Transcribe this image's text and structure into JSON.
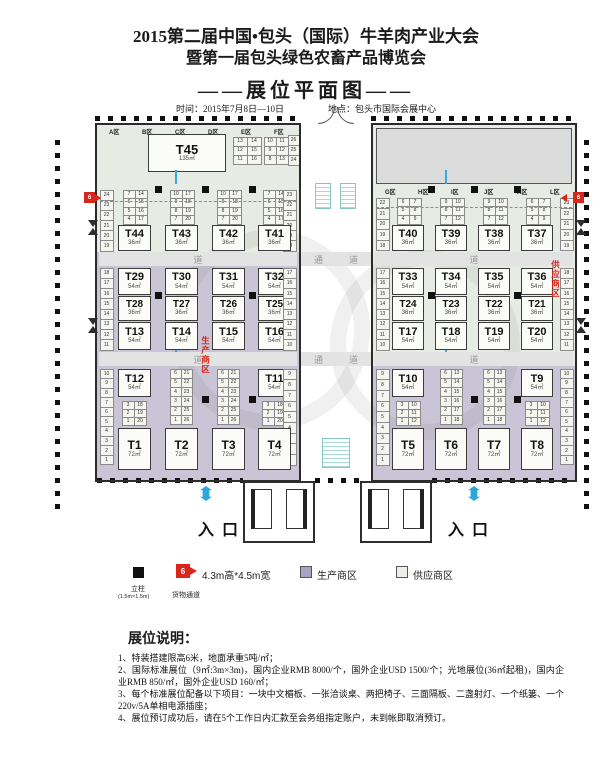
{
  "header": {
    "title_line1": "2015第二届中国•包头（国际）牛羊肉产业大会",
    "title_line2": "暨第一届包头绿色农畜产品博览会",
    "plan_title": "——展位平面图——",
    "time_label": "时间：2015年7月8日—10日",
    "venue_label": "地点：包头市国际会展中心"
  },
  "plan": {
    "entrance_label": "入口",
    "corridor_chars": [
      "通",
      "道"
    ],
    "aisle_char": "道",
    "production_area_label": "生产商区",
    "supply_area_label": "供应商区",
    "goods_channel_num": "6",
    "left_hall": {
      "zones": [
        "A区",
        "B区",
        "C区",
        "D区",
        "E区",
        "F区"
      ],
      "big_booth": {
        "id": "T45",
        "size": "135㎡"
      },
      "t45_grids": [
        [
          [
            "13",
            "14"
          ],
          [
            "12",
            "15"
          ],
          [
            "11",
            "16"
          ]
        ],
        [
          [
            "10",
            "11"
          ],
          [
            "9",
            "12"
          ],
          [
            "8",
            "13"
          ]
        ]
      ],
      "corner_strip": [
        "26",
        "25",
        "24"
      ],
      "row1_grids": [
        [
          [
            "7",
            "14"
          ],
          [
            "6",
            "15"
          ],
          [
            "5",
            "16"
          ],
          [
            "4",
            "17"
          ]
        ],
        [
          [
            "10",
            "17"
          ],
          [
            "9",
            "18"
          ],
          [
            "8",
            "19"
          ],
          [
            "7",
            "20"
          ]
        ],
        [
          [
            "10",
            "17"
          ],
          [
            "9",
            "18"
          ],
          [
            "8",
            "19"
          ],
          [
            "7",
            "20"
          ]
        ],
        [
          [
            "7",
            "14"
          ],
          [
            "6",
            "15"
          ],
          [
            "5",
            "16"
          ],
          [
            "4",
            "17"
          ]
        ]
      ],
      "row1_booths": [
        {
          "id": "T44",
          "size": "36㎡"
        },
        {
          "id": "T43",
          "size": "36㎡"
        },
        {
          "id": "T42",
          "size": "36㎡"
        },
        {
          "id": "T41",
          "size": "36㎡"
        }
      ],
      "row1_strip_left": [
        "24",
        "23",
        "22",
        "21",
        "20",
        "19"
      ],
      "row1_strip_right": [
        "23",
        "22",
        "21",
        "20",
        "19",
        "18"
      ],
      "mid_columns": [
        [
          {
            "id": "T29",
            "size": "54㎡"
          },
          {
            "id": "T28",
            "size": "36㎡"
          },
          {
            "id": "T13",
            "size": "54㎡"
          }
        ],
        [
          {
            "id": "T30",
            "size": "54㎡"
          },
          {
            "id": "T27",
            "size": "36㎡"
          },
          {
            "id": "T14",
            "size": "54㎡"
          }
        ],
        [
          {
            "id": "T31",
            "size": "54㎡"
          },
          {
            "id": "T26",
            "size": "36㎡"
          },
          {
            "id": "T15",
            "size": "54㎡"
          }
        ],
        [
          {
            "id": "T32",
            "size": "54㎡"
          },
          {
            "id": "T25",
            "size": "36㎡"
          },
          {
            "id": "T16",
            "size": "54㎡"
          }
        ]
      ],
      "mid_strip_left": [
        "18",
        "17",
        "16",
        "15",
        "14",
        "13",
        "12",
        "11"
      ],
      "mid_strip_right": [
        "17",
        "16",
        "15",
        "14",
        "13",
        "12",
        "11",
        "10"
      ],
      "bottom_left_booth": {
        "id": "T12",
        "size": "54㎡"
      },
      "bottom_right_booth": {
        "id": "T11",
        "size": "54㎡"
      },
      "bottom_grids": [
        [
          [
            "6",
            "21"
          ],
          [
            "5",
            "22"
          ],
          [
            "4",
            "23"
          ],
          [
            "3",
            "24"
          ],
          [
            "2",
            "25"
          ],
          [
            "1",
            "26"
          ]
        ],
        [
          [
            "6",
            "21"
          ],
          [
            "5",
            "22"
          ],
          [
            "4",
            "23"
          ],
          [
            "3",
            "24"
          ],
          [
            "2",
            "25"
          ],
          [
            "1",
            "26"
          ]
        ]
      ],
      "bottom_mini_grids": [
        [
          [
            "3",
            "18"
          ],
          [
            "2",
            "19"
          ],
          [
            "1",
            "20"
          ]
        ],
        [
          [
            "3",
            "18"
          ],
          [
            "2",
            "19"
          ],
          [
            "1",
            "20"
          ]
        ]
      ],
      "bottom_strip_left": [
        "10",
        "9",
        "8",
        "7",
        "6",
        "5",
        "4",
        "3",
        "2",
        "1"
      ],
      "bottom_strip_right": [
        "9",
        "8",
        "7",
        "6",
        "5",
        "4",
        "3",
        "2",
        "1"
      ],
      "last_row_booths": [
        {
          "id": "T1",
          "size": "72㎡"
        },
        {
          "id": "T2",
          "size": "72㎡"
        },
        {
          "id": "T3",
          "size": "72㎡"
        },
        {
          "id": "T4",
          "size": "72㎡"
        }
      ]
    },
    "right_hall": {
      "zones": [
        "G区",
        "H区",
        "I区",
        "J区",
        "K区",
        "L区"
      ],
      "row1_grids": [
        [
          [
            "6",
            "7"
          ],
          [
            "5",
            "8"
          ],
          [
            "4",
            "9"
          ]
        ],
        [
          [
            "9",
            "10"
          ],
          [
            "8",
            "11"
          ],
          [
            "7",
            "12"
          ]
        ],
        [
          [
            "9",
            "10"
          ],
          [
            "8",
            "11"
          ],
          [
            "7",
            "12"
          ]
        ],
        [
          [
            "6",
            "7"
          ],
          [
            "5",
            "8"
          ],
          [
            "4",
            "9"
          ]
        ]
      ],
      "row1_booths": [
        {
          "id": "T40",
          "size": "36㎡"
        },
        {
          "id": "T39",
          "size": "36㎡"
        },
        {
          "id": "T38",
          "size": "36㎡"
        },
        {
          "id": "T37",
          "size": "36㎡"
        }
      ],
      "row1_strip_left": [
        "22",
        "21",
        "20",
        "19",
        "18"
      ],
      "row1_strip_right": [
        "23",
        "22",
        "21",
        "20",
        "19"
      ],
      "mid_columns": [
        [
          {
            "id": "T33",
            "size": "54㎡"
          },
          {
            "id": "T24",
            "size": "36㎡"
          },
          {
            "id": "T17",
            "size": "54㎡"
          }
        ],
        [
          {
            "id": "T34",
            "size": "54㎡"
          },
          {
            "id": "T23",
            "size": "36㎡"
          },
          {
            "id": "T18",
            "size": "54㎡"
          }
        ],
        [
          {
            "id": "T35",
            "size": "54㎡"
          },
          {
            "id": "T22",
            "size": "36㎡"
          },
          {
            "id": "T19",
            "size": "54㎡"
          }
        ],
        [
          {
            "id": "T36",
            "size": "54㎡"
          },
          {
            "id": "T21",
            "size": "36㎡"
          },
          {
            "id": "T20",
            "size": "54㎡"
          }
        ]
      ],
      "mid_strip_left": [
        "17",
        "16",
        "15",
        "14",
        "13",
        "12",
        "11",
        "10"
      ],
      "mid_strip_right": [
        "18",
        "17",
        "16",
        "15",
        "14",
        "13",
        "12",
        "11"
      ],
      "bottom_left_booth": {
        "id": "T10",
        "size": "54㎡"
      },
      "bottom_right_booth": {
        "id": "T9",
        "size": "54㎡"
      },
      "bottom_grids": [
        [
          [
            "6",
            "13"
          ],
          [
            "5",
            "14"
          ],
          [
            "4",
            "15"
          ],
          [
            "3",
            "16"
          ],
          [
            "2",
            "17"
          ],
          [
            "1",
            "18"
          ]
        ],
        [
          [
            "6",
            "13"
          ],
          [
            "5",
            "14"
          ],
          [
            "4",
            "15"
          ],
          [
            "3",
            "16"
          ],
          [
            "2",
            "17"
          ],
          [
            "1",
            "18"
          ]
        ]
      ],
      "bottom_mini_grids": [
        [
          [
            "3",
            "10"
          ],
          [
            "2",
            "11"
          ],
          [
            "1",
            "12"
          ]
        ],
        [
          [
            "3",
            "10"
          ],
          [
            "2",
            "11"
          ],
          [
            "1",
            "12"
          ]
        ]
      ],
      "bottom_strip_left": [
        "9",
        "8",
        "7",
        "6",
        "5",
        "4",
        "3",
        "2",
        "1"
      ],
      "bottom_strip_right": [
        "10",
        "9",
        "8",
        "7",
        "6",
        "5",
        "4",
        "3",
        "2",
        "1"
      ],
      "last_row_booths": [
        {
          "id": "T5",
          "size": "72㎡"
        },
        {
          "id": "T6",
          "size": "72㎡"
        },
        {
          "id": "T7",
          "size": "72㎡"
        },
        {
          "id": "T8",
          "size": "72㎡"
        }
      ]
    }
  },
  "legend": {
    "column_label": "立柱",
    "column_dims": "(1.5m×1.5m)",
    "goods_num": "6",
    "goods_dims": "4.3m高*4.5m宽",
    "goods_label": "货物通道",
    "production_label": "生产商区",
    "supply_label": "供应商区"
  },
  "notes": {
    "heading": "展位说明：",
    "items": [
      "1、特装搭建限高6米，地面承重5吨/㎡；",
      "2、国际标准展位（9㎡:3m×3m)，国内企业RMB 8000/个，国外企业USD 1500/个；光地展位(36㎡起租)，国内企业RMB 850/㎡，国外企业USD 160/㎡；",
      "3、每个标准展位配备以下项目：一块中文楣板、一张洽谈桌、两把椅子、三面隔板、二盏射灯、一个纸篓、一个220v/5A单相电源插座；",
      "4、展位预订成功后，请在5个工作日内汇款至会务组指定账户，未到帐即取消预订。"
    ]
  },
  "colors": {
    "production": "#c9c4d6",
    "supply": "#e6ebe3",
    "stage": "#dcdcdc",
    "band": "#e3e3e3",
    "red": "#d8261d",
    "blue": "#2ba7dc"
  }
}
